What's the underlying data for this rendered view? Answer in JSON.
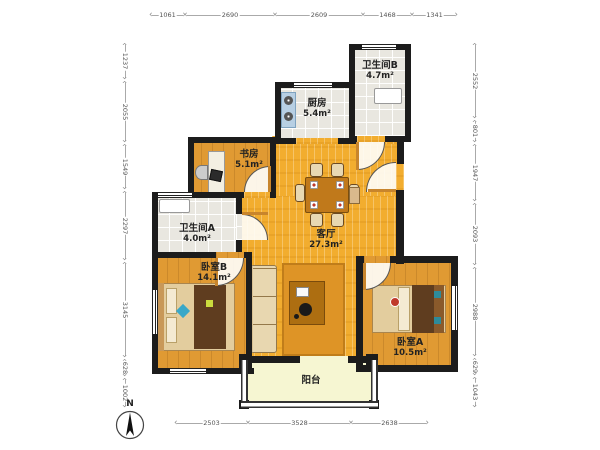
{
  "plan": {
    "rooms": {
      "kitchen": {
        "name": "厨房",
        "area": "5.4m²"
      },
      "bathroom_b": {
        "name": "卫生间B",
        "area": "4.7m²"
      },
      "study": {
        "name": "书房",
        "area": "5.1m²"
      },
      "bathroom_a": {
        "name": "卫生间A",
        "area": "4.0m²"
      },
      "living_room": {
        "name": "客厅",
        "area": "27.3m²"
      },
      "bedroom_b": {
        "name": "卧室B",
        "area": "14.1m²"
      },
      "bedroom_a": {
        "name": "卧室A",
        "area": "10.5m²"
      },
      "balcony": {
        "name": "阳台",
        "area": ""
      }
    },
    "compass": {
      "label": "N"
    }
  },
  "dimensions": {
    "top": [
      "1061",
      "2690",
      "2609",
      "1468",
      "1341"
    ],
    "left": [
      "1237",
      "2055",
      "1549",
      "2297",
      "3145",
      "628",
      "1002"
    ],
    "right": [
      "2552",
      "801",
      "1947",
      "2093",
      "2988",
      "629",
      "1043"
    ],
    "bottom": [
      "2503",
      "3528",
      "2638"
    ]
  },
  "colors": {
    "wall": "#1c1c1c",
    "living_floor": "#f2ad2f",
    "wood_floor": "#e09a33",
    "tile_floor": "#e9e7e0",
    "balcony_floor": "#f6f6d2",
    "rug": "#de9426"
  }
}
